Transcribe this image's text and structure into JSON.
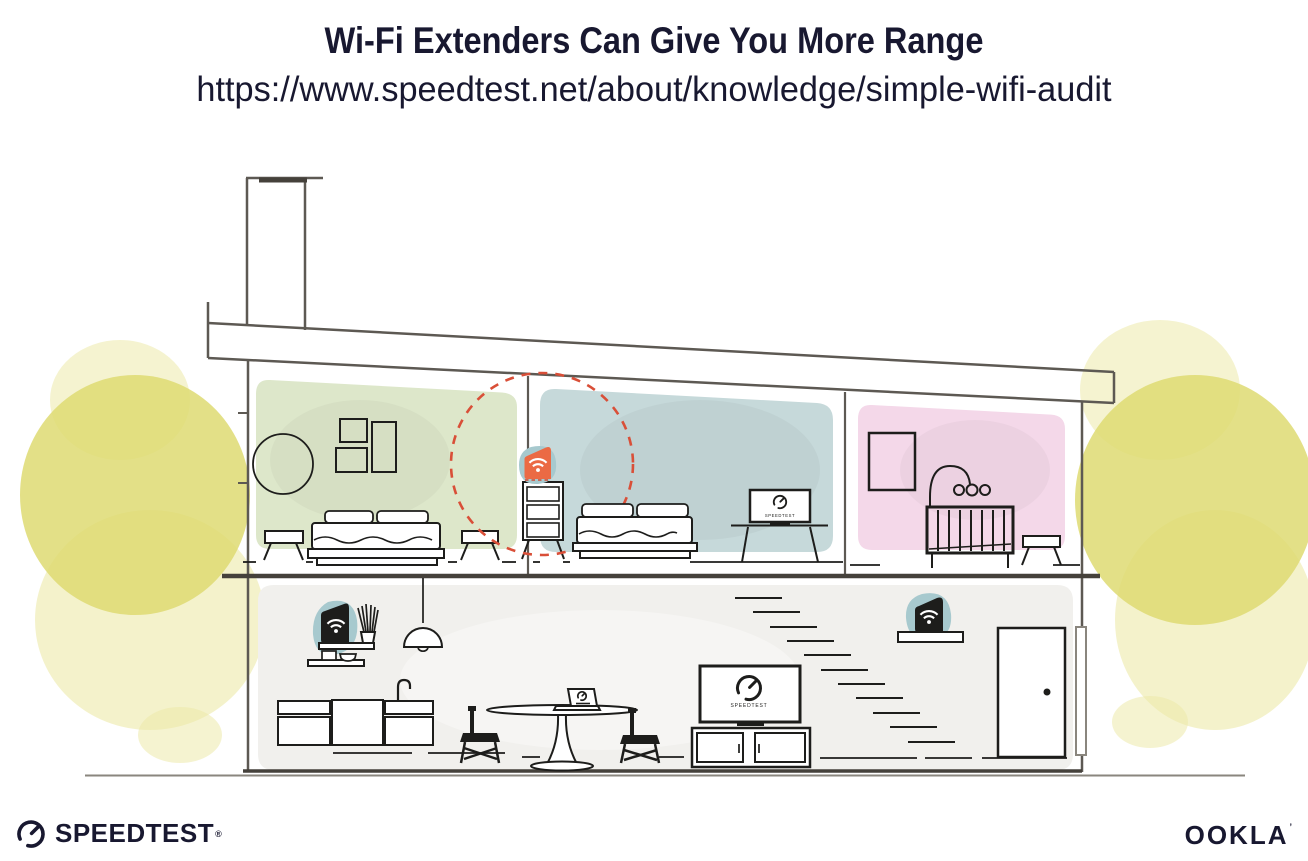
{
  "header": {
    "title": "Wi-Fi Extenders Can Give You More Range",
    "url": "https://www.speedtest.net/about/knowledge/simple-wifi-audit"
  },
  "illustration": {
    "bedroom_tv_label": "SPEEDTEST",
    "living_tv_label": "SPEEDTEST"
  },
  "footer": {
    "speedtest_wordmark": "SPEEDTEST",
    "speedtest_trademark": "®",
    "ookla_wordmark": "OOKLA",
    "ookla_trademark": "’"
  },
  "colors": {
    "ink": "#181830",
    "line_gray": "#5d5953",
    "line_dark": "#45413b",
    "black": "#1d1d1b",
    "room_green": "#dde7ca",
    "room_blue": "#c6d9da",
    "room_pink": "#f4d8e9",
    "room_gray": "#f1f0ed",
    "teal": "#a7c9ce",
    "orange": "#eb6a44",
    "orange_dark": "#cf4a30",
    "red": "#d94f38",
    "foliage": "#deda72",
    "foliage_light": "#eceaa9",
    "ground": "#8a867e"
  }
}
